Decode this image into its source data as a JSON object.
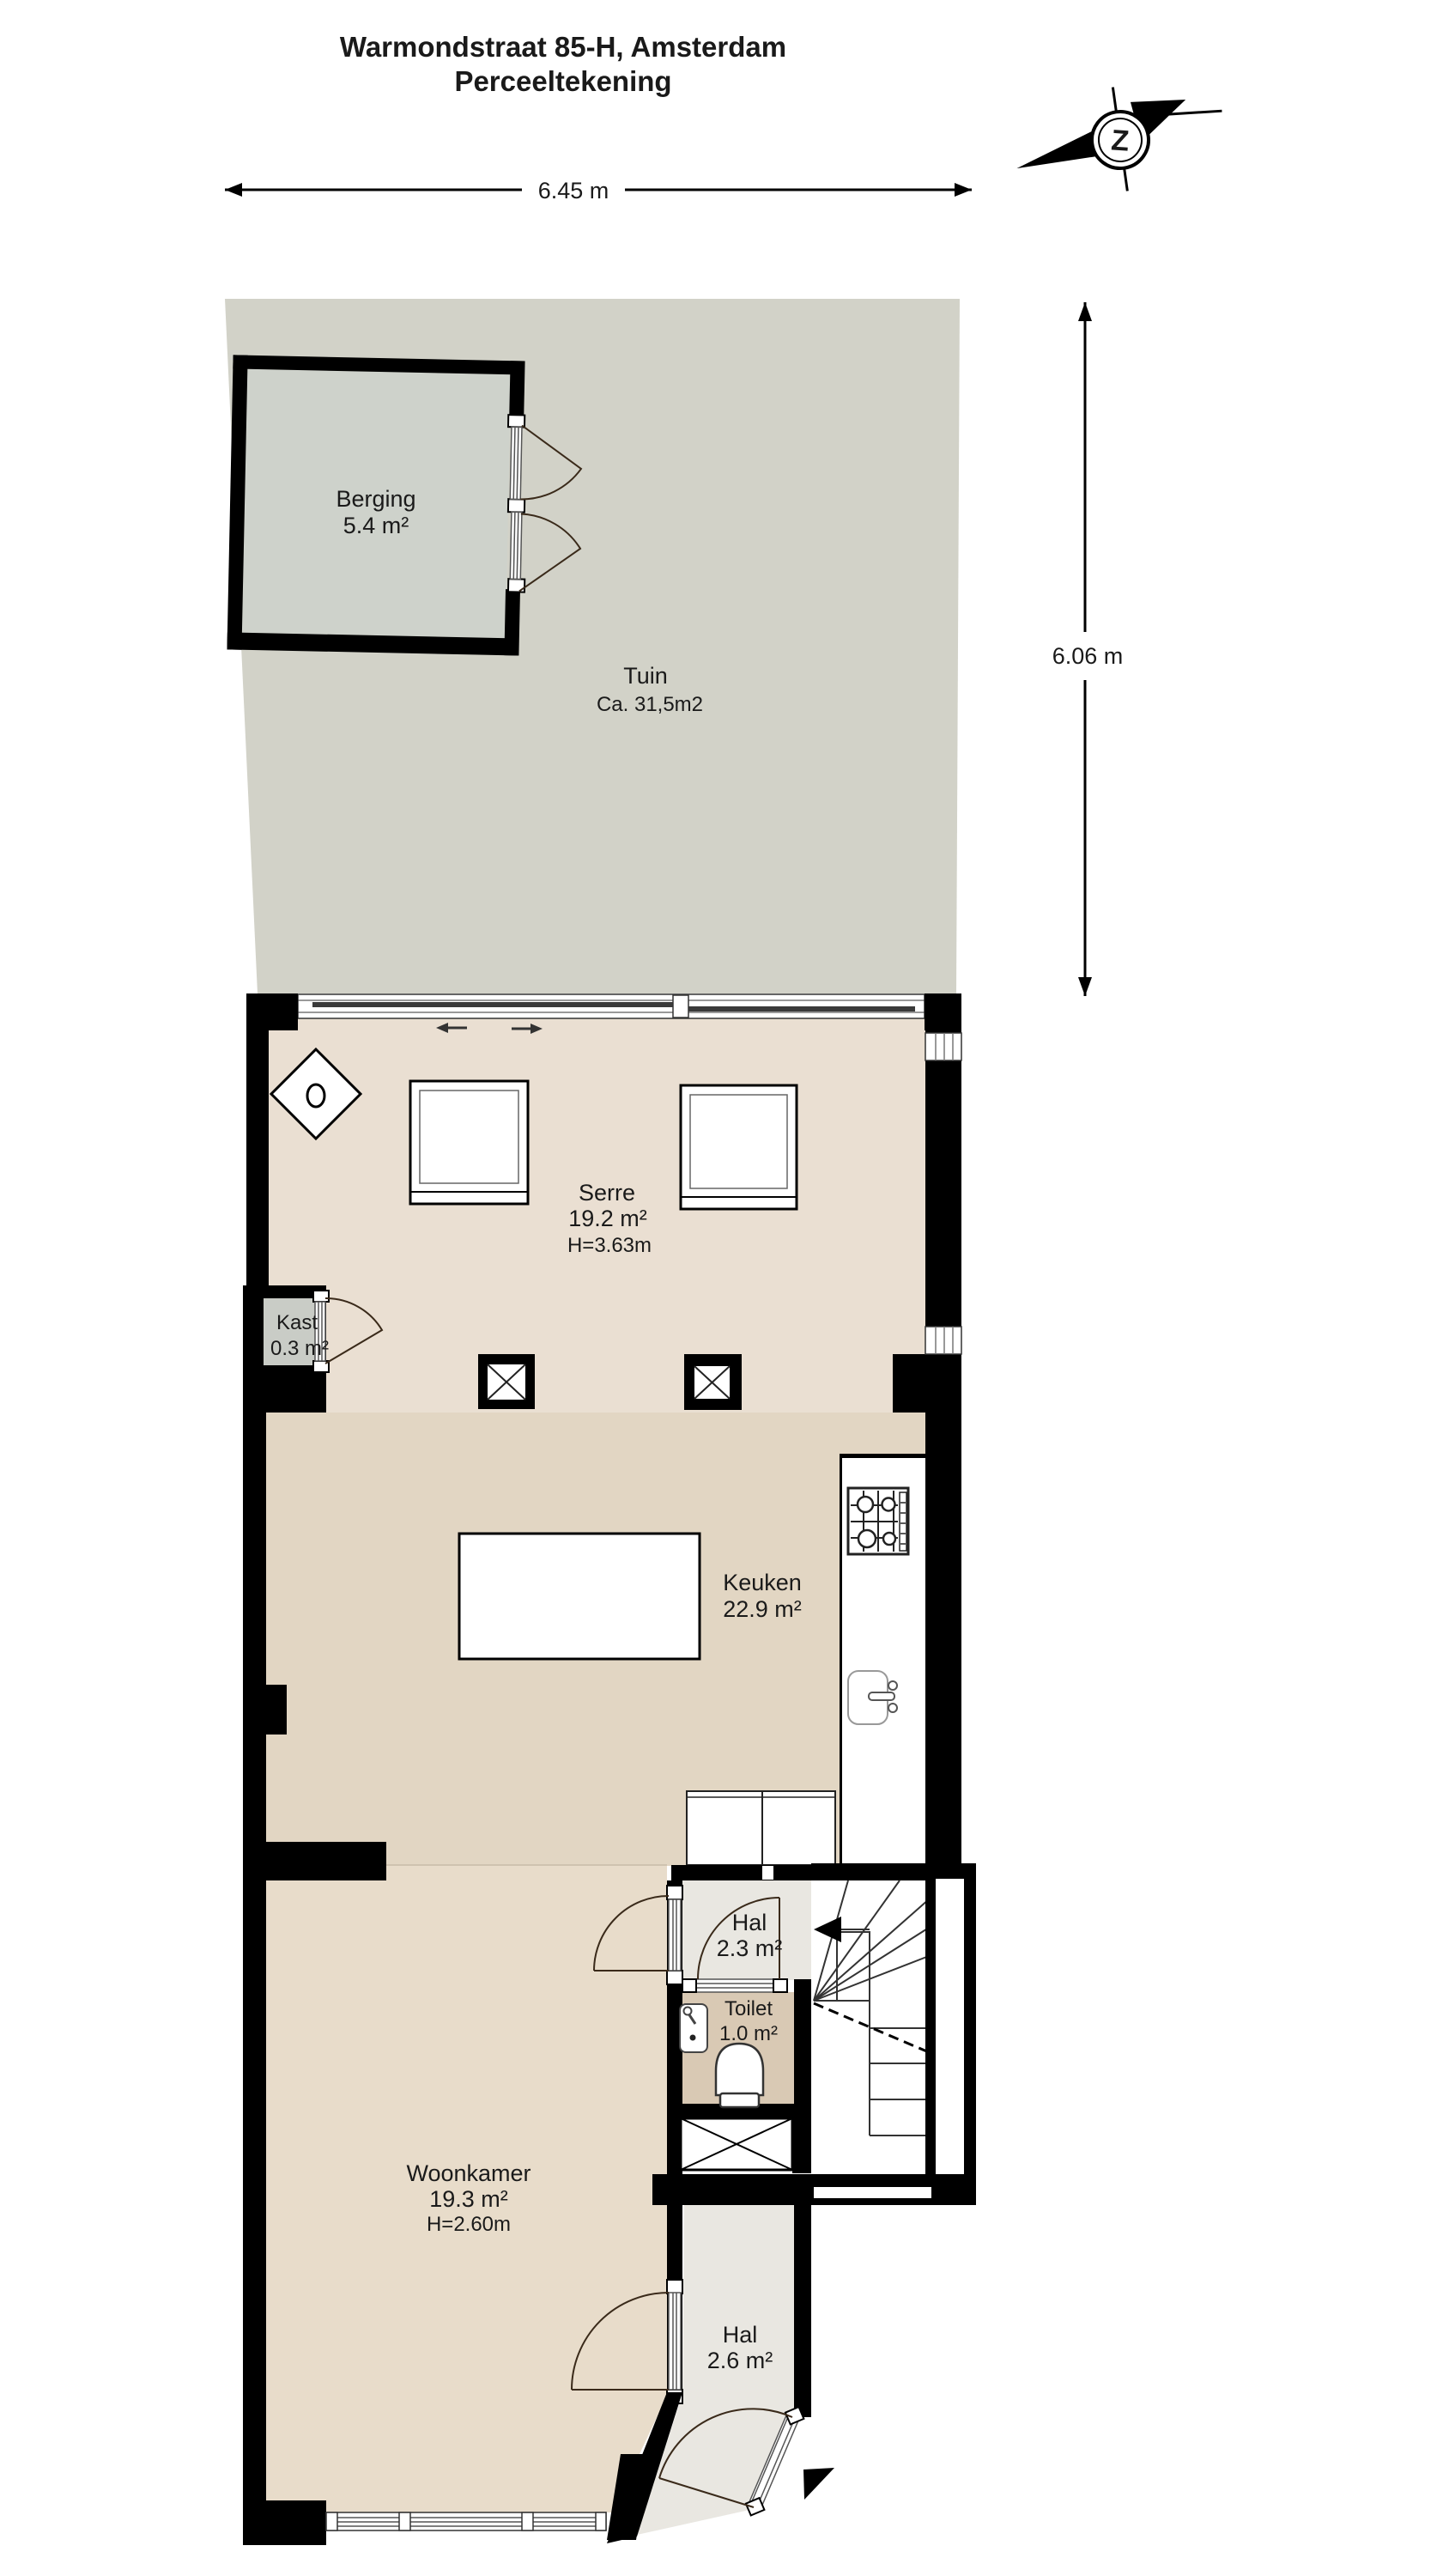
{
  "title": {
    "line1": "Warmondstraat 85-H, Amsterdam",
    "line2": "Perceeltekening"
  },
  "compass": {
    "letter": "Z"
  },
  "dimensions": {
    "plot_width": "6.45 m",
    "plot_depth": "6.06 m"
  },
  "rooms": {
    "berging": {
      "name": "Berging",
      "area": "5.4 m²"
    },
    "tuin": {
      "name": "Tuin",
      "area": "Ca. 31,5m2"
    },
    "serre": {
      "name": "Serre",
      "area": "19.2 m²",
      "height": "H=3.63m"
    },
    "kast": {
      "name": "Kast",
      "area": "0.3 m²"
    },
    "keuken": {
      "name": "Keuken",
      "area": "22.9 m²"
    },
    "hal_boven": {
      "name": "Hal",
      "area": "2.3 m²"
    },
    "toilet": {
      "name": "Toilet",
      "area": "1.0 m²"
    },
    "woonkamer": {
      "name": "Woonkamer",
      "area": "19.3 m²",
      "height": "H=2.60m"
    },
    "hal_entree": {
      "name": "Hal",
      "area": "2.6 m²"
    }
  },
  "colors": {
    "garden": "#d2d2c8",
    "berging_floor": "#ced2cb",
    "serre_floor": "#eadfd2",
    "keuken_floor": "#e2d6c3",
    "woonkamer_floor": "#e8dcca",
    "hal_floor": "#e9e7e1",
    "toilet_floor": "#d9c9b4",
    "kast_floor": "#c9ccc6",
    "wall": "#000000"
  }
}
